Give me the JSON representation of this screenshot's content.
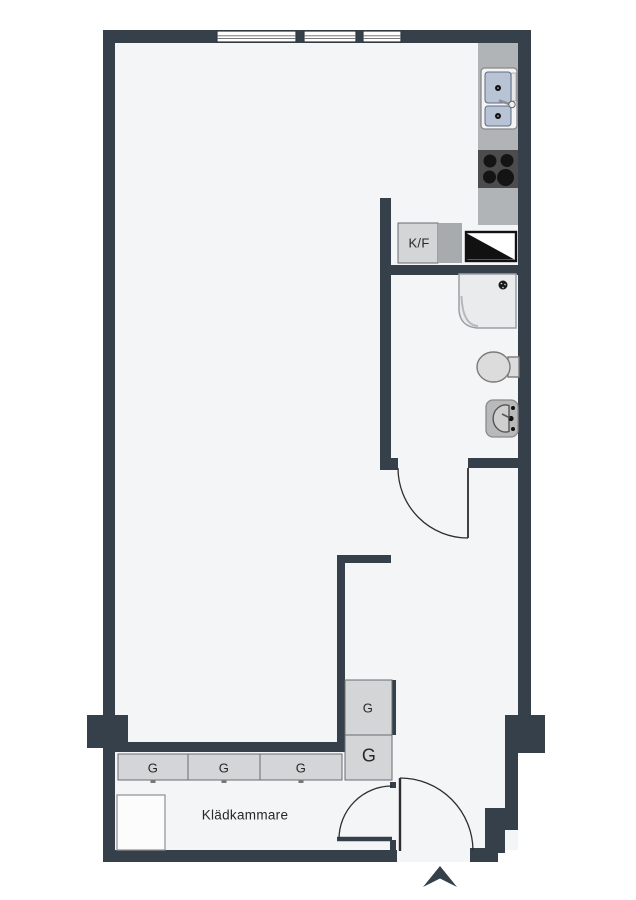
{
  "plan": {
    "title": "apartment-floor-plan",
    "labels": {
      "fridge_freezer": "K/F",
      "wardrobe_row": [
        "G",
        "G",
        "G"
      ],
      "wardrobe_col_top": "G",
      "wardrobe_col_bottom": "G",
      "closet_room": "Klädkammare"
    },
    "fixtures": {
      "kitchen-sink-icon": "double basin with faucet and drainboard",
      "stove-icon": "4 burner cooktop circles",
      "fridge-freezer-icon": "K/F cabinet box",
      "dishwasher-icon": "square split diagonally black/white",
      "shower-icon": "square tray with rounded corner and drain",
      "toilet-icon": "oval bowl with cistern",
      "washbasin-icon": "rounded basin with tap",
      "window-icon": "triple-line glazing bars in wall",
      "entrance-arrow-icon": "solid chevron pointing up at entry door",
      "wardrobe-icon": "G cabinet box",
      "door-icon": "quarter-circle swing arc with leaf"
    },
    "colors": {
      "wall": "#36404a",
      "floor": "#f4f5f6",
      "outside": "#ffffff",
      "counter": "#b1b4b6",
      "counter_dark": "#a8abad",
      "cabinet": "#d4d5d6",
      "cabinet_border": "#666c72",
      "stove": "#4c4c4c",
      "burner": "#141414",
      "sink_basin": "#b8c3d6",
      "sink_basin_border": "#5e6b7e",
      "fixture_fill": "#dcdcdc",
      "fixture_border": "#7a7a7a",
      "shower_fill": "#e9ebec",
      "shower_border": "#9aa0a5",
      "appliance_black": "#111111",
      "door_line": "#2e2e2e",
      "text": "#272727"
    }
  }
}
